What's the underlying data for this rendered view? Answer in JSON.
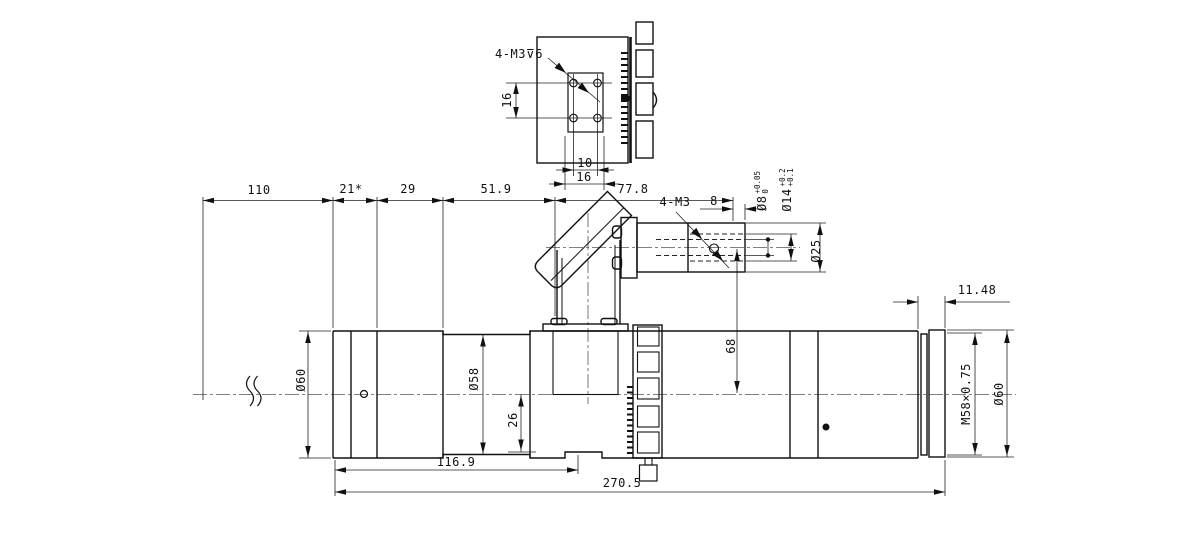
{
  "top_view": {
    "thread_note": "4-M3⊽6",
    "dim_hole_spacing_vertical": "16",
    "dim_hole_spacing_horizontal": "10",
    "dim_plate_width": "16"
  },
  "dims_top_chain": {
    "d1": "110",
    "d2": "21*",
    "d3": "29",
    "d4": "51.9",
    "d5": "77.8"
  },
  "elbow": {
    "thread_note": "4-M3",
    "dim_thread_offset": "8",
    "dia_bore_small": "Ø8",
    "dia_bore_small_tol_hi": "+0.05",
    "dia_bore_small_tol_lo": "0",
    "dia_bore_large": "Ø14",
    "dia_bore_large_tol_hi": "+0.2",
    "dia_bore_large_tol_lo": "+0.1",
    "dia_tube": "Ø25",
    "dim_axis_height": "68"
  },
  "barrel": {
    "dia_left": "Ø60",
    "dia_mid": "Ø58",
    "dim_port_offset": "26",
    "dim_thread_length": "11.48",
    "thread_spec": "M58×0.75",
    "dia_right": "Ø60",
    "dim_body_length": "116.9",
    "dim_total_length": "270.5"
  }
}
